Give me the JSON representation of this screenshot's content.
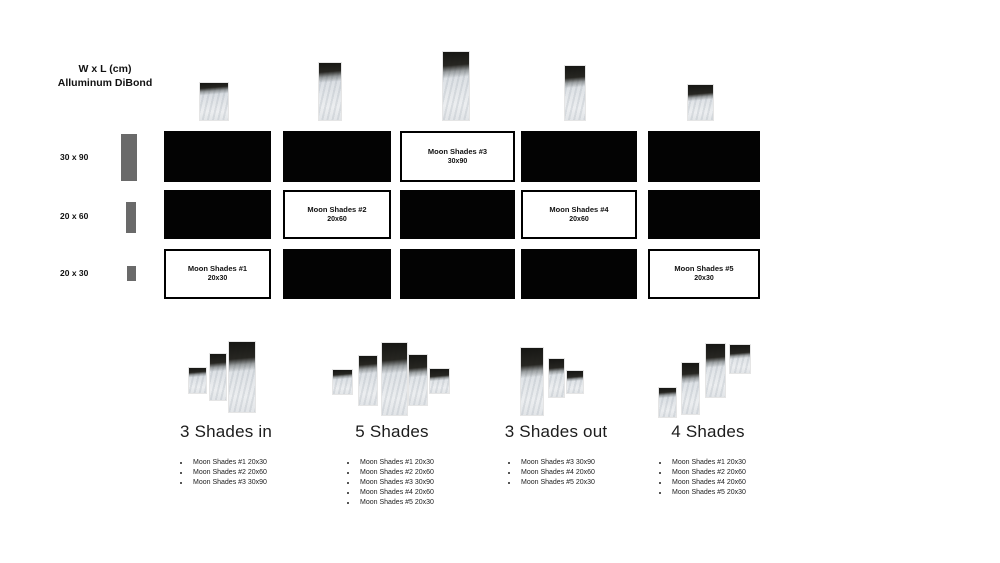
{
  "header": {
    "line1": "W x L (cm)",
    "line2": "Alluminum DiBond"
  },
  "sizes": [
    {
      "label": "30 x 90"
    },
    {
      "label": "20 x 60"
    },
    {
      "label": "20 x 30"
    }
  ],
  "grid": {
    "rows": [
      {
        "cells": [
          {
            "type": "black"
          },
          {
            "type": "black"
          },
          {
            "type": "label",
            "title": "Moon Shades #3",
            "size": "30x90"
          },
          {
            "type": "black"
          },
          {
            "type": "black"
          }
        ]
      },
      {
        "cells": [
          {
            "type": "black"
          },
          {
            "type": "label",
            "title": "Moon Shades #2",
            "size": "20x60"
          },
          {
            "type": "black"
          },
          {
            "type": "label",
            "title": "Moon Shades #4",
            "size": "20x60"
          },
          {
            "type": "black"
          }
        ]
      },
      {
        "cells": [
          {
            "type": "label",
            "title": "Moon Shades #1",
            "size": "20x30"
          },
          {
            "type": "black"
          },
          {
            "type": "black"
          },
          {
            "type": "black"
          },
          {
            "type": "label",
            "title": "Moon Shades #5",
            "size": "20x30"
          }
        ]
      }
    ]
  },
  "groups": [
    {
      "title": "3 Shades in",
      "items": [
        "Moon Shades #1 20x30",
        "Moon Shades #2 20x60",
        "Moon Shades #3 30x90"
      ]
    },
    {
      "title": "5 Shades",
      "items": [
        "Moon Shades #1 20x30",
        "Moon Shades #2 20x60",
        "Moon Shades #3 30x90",
        "Moon Shades #4 20x60",
        "Moon Shades #5 20x30"
      ]
    },
    {
      "title": "3 Shades out",
      "items": [
        "Moon Shades #3 30x90",
        "Moon Shades #4 20x60",
        "Moon Shades #5 20x30"
      ]
    },
    {
      "title": "4 Shades",
      "items": [
        "Moon Shades #1 20x30",
        "Moon Shades #2 20x60",
        "Moon Shades #4 20x60",
        "Moon Shades #5 20x30"
      ]
    }
  ],
  "colors": {
    "panel": "#030303",
    "bar": "#6a6a6a",
    "background": "#ffffff"
  }
}
